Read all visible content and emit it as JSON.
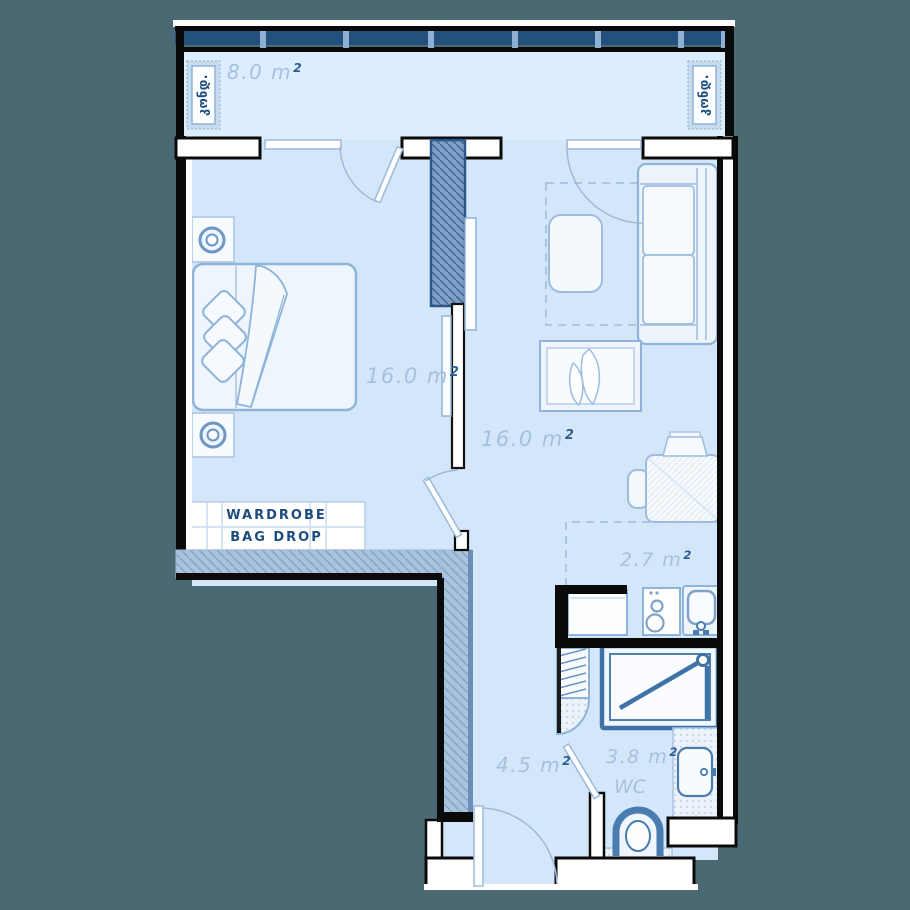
{
  "colors": {
    "background": "#4a6973",
    "floor": "#d4e7fa",
    "accent_dark": "#1d4c80",
    "wall_navy": "#24507d",
    "fixture_stroke": "#4a7caf"
  },
  "balcony": {
    "area": "8.0 m",
    "sup": "2",
    "ac_left": "კონდ.",
    "ac_right": "კონდ."
  },
  "bedroom": {
    "area": "16.0 m",
    "sup": "2",
    "closet_line1": "WARDROBE",
    "closet_line2": "BAG DROP"
  },
  "living": {
    "area": "16.0 m",
    "sup": "2"
  },
  "kitchen": {
    "area": "2.7 m",
    "sup": "2"
  },
  "hallway": {
    "area": "4.5 m",
    "sup": "2"
  },
  "bathroom": {
    "area": "3.8 m",
    "sup": "2",
    "label": "WC"
  }
}
